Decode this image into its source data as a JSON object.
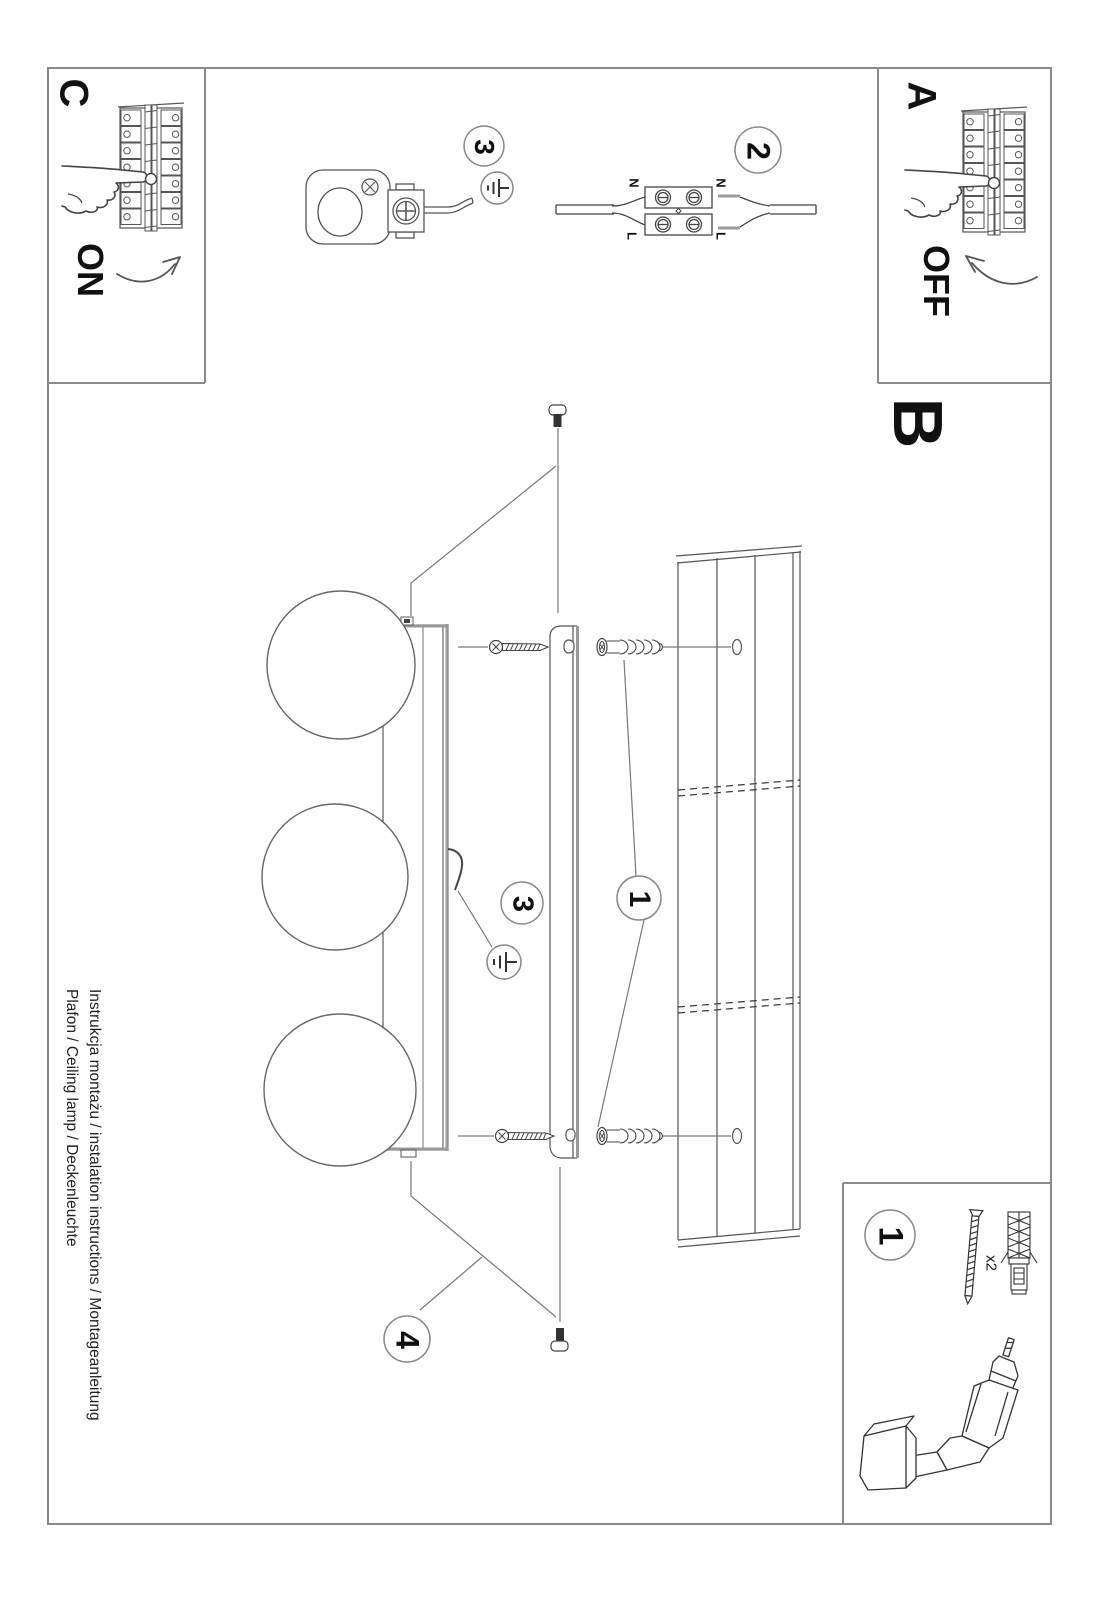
{
  "document": {
    "product_line1": "Instrukcja montażu / instalation instructions / Montageanleitung",
    "product_line2": "Plafon / Ceiling lamp / Deckenleuchte"
  },
  "steps": {
    "a": {
      "label": "A",
      "action": "OFF"
    },
    "b": {
      "label": "B"
    },
    "c": {
      "label": "C",
      "action": "ON"
    }
  },
  "callouts": {
    "socket_earth_step": "3",
    "wiring_step": "2",
    "anchor_step": "1",
    "earth_step": "3",
    "decor_bolt_step": "4",
    "toolbox_step": "1",
    "toolbox_quantity": "x2"
  },
  "wiring_labels": {
    "left_n": "N",
    "left_l": "L",
    "right_n": "N",
    "right_l": "L"
  },
  "colors": {
    "line": "#555555",
    "frame": "#8a8a8a",
    "text": "#111111"
  }
}
